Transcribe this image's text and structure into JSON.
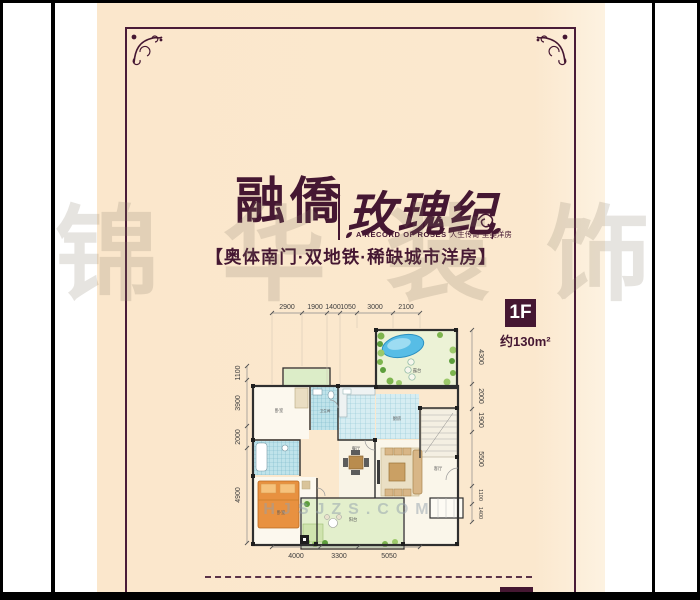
{
  "poster": {
    "brand": "融僑",
    "series_title": "玫瑰纪",
    "subtitle_en": "A RECORD OF ROSES",
    "subtitle_cn": "人生传奇 至美洋房",
    "tagline": "【奥体南门·双地铁·稀缺城市洋房】",
    "floor_badge": "1F",
    "floor_area": "约130m²"
  },
  "floorplan": {
    "dims_top": [
      "2900",
      "1900",
      "1400",
      "1050",
      "3000",
      "2100"
    ],
    "dims_left": [
      "1100",
      "3900",
      "2000",
      "4900"
    ],
    "dims_right": [
      "4300",
      "2000",
      "1900",
      "5500",
      "1100",
      "1400"
    ],
    "dims_bottom": [
      "4000",
      "3300",
      "5050"
    ],
    "rooms": [
      {
        "label": "露台"
      },
      {
        "label": "厨房"
      },
      {
        "label": "餐厅"
      },
      {
        "label": "客厅"
      },
      {
        "label": "卧室"
      },
      {
        "label": "卫生间"
      },
      {
        "label": "卧室"
      },
      {
        "label": "阳台"
      }
    ]
  },
  "watermark": {
    "chars": [
      "锦",
      "华",
      "装",
      "饰"
    ],
    "site": "HJSJZS.COM"
  },
  "colors": {
    "paper": "#fbe8ce",
    "maroon": "#451732",
    "frame_black": "#000000",
    "tile_teal": "#bfe3ea",
    "plant_green": "#7db54e",
    "bed_orange": "#e89140",
    "pond_blue": "#57bde6"
  }
}
